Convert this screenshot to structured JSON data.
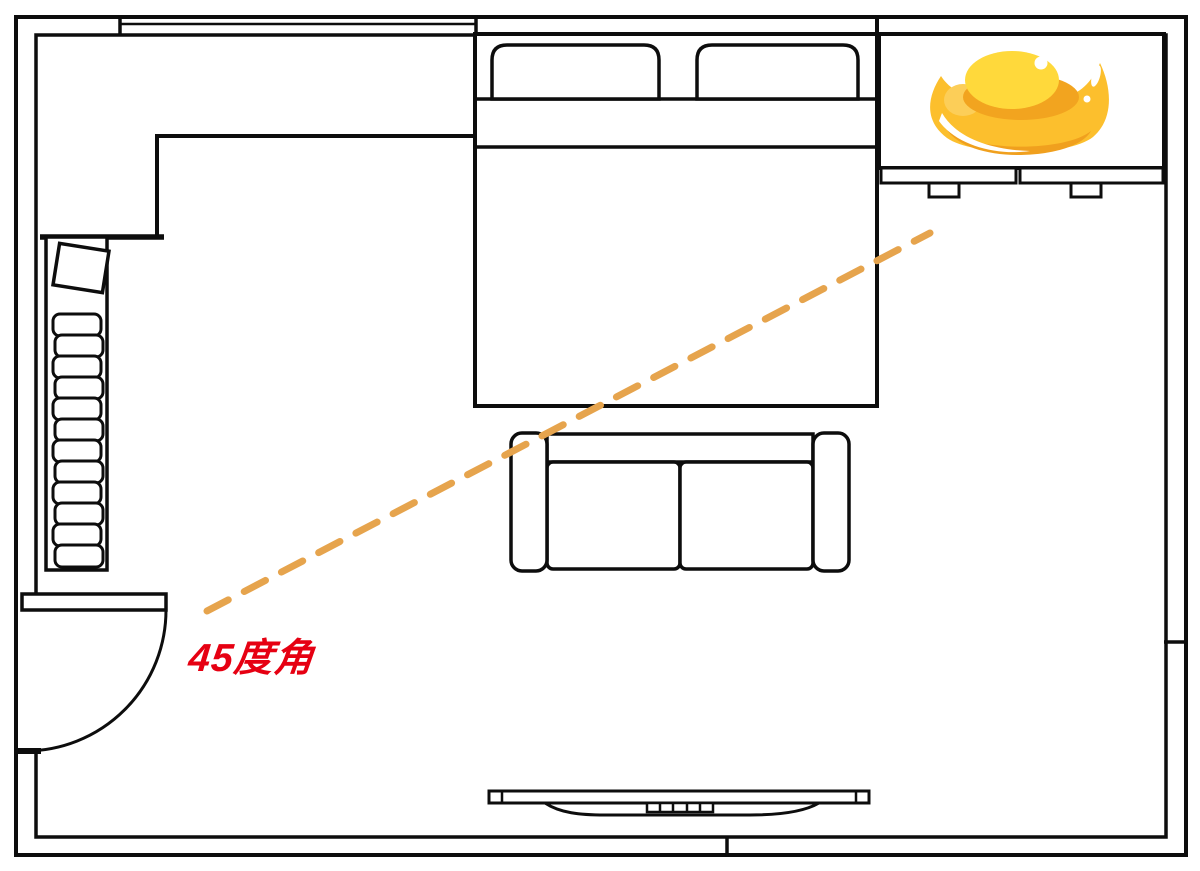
{
  "annotation": {
    "angle_label": "45度角"
  },
  "colors": {
    "background": "#ffffff",
    "wall_line": "#0d0d0d",
    "dashed_line": "#e6a44d",
    "label_red": "#e60012",
    "ingot_body": "#fcbf2d",
    "ingot_dome": "#ffd93b",
    "ingot_inner_shadow": "#f2a41f",
    "ingot_bottom_shade": "#f0a01e",
    "ingot_soft_patch": "#fcce58",
    "ingot_highlight": "#ffffff"
  },
  "diagram": {
    "type": "floor-plan",
    "furniture": [
      "window",
      "closet-niche",
      "wardrobe-shelf",
      "storage-box",
      "entry-door",
      "double-bed",
      "pillow-left",
      "pillow-right",
      "corner-desk",
      "gold-ingot",
      "sofa",
      "tv-cabinet"
    ],
    "sightline": {
      "style": "dashed",
      "from": "entry-door",
      "to": "corner-desk",
      "label": "45度角"
    }
  }
}
